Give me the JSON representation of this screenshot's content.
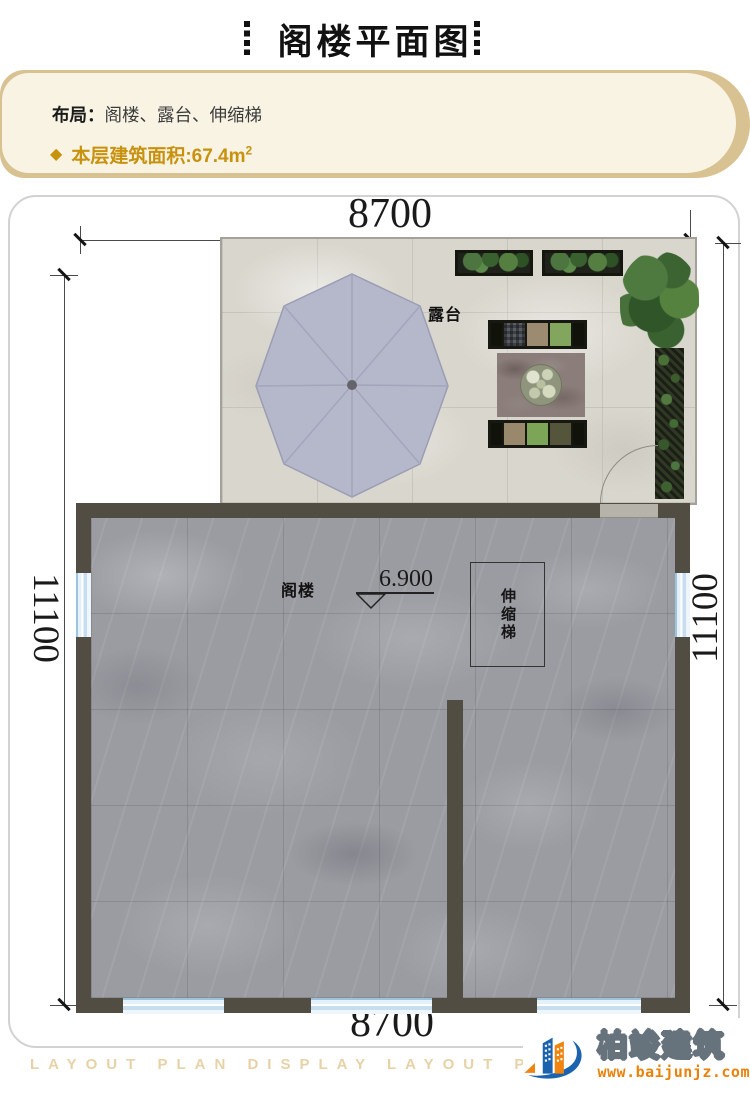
{
  "header": {
    "title": "阁楼平面图"
  },
  "info": {
    "layout_label": "布局：",
    "layout_value": "阁楼、露台、伸缩梯",
    "diamond_icon": "◆",
    "area_label": "本层建筑面积:",
    "area_value": "67.4m",
    "area_sup": "2"
  },
  "plan": {
    "dims": {
      "top": "8700",
      "bottom": "8700",
      "left": "11100",
      "right": "11100"
    },
    "terrace_label": "露台",
    "attic_label": "阁楼",
    "ladder_label": "伸缩梯",
    "elevation": "6.900"
  },
  "footer": {
    "watermark": "LAYOUT PLAN DISPLAY LAYOUT PLAN DI",
    "brand_name": "柏竣建筑",
    "website": "www.baijunjz.com"
  },
  "colors": {
    "accent_gold": "#c8920f",
    "panel_cream": "#f8f3e3",
    "panel_tan": "#d9c292",
    "wall": "#514d43",
    "marble": "#9a9ca2",
    "terrace_floor": "#d9d6cd",
    "window_blue": "#cfe6f4",
    "umbrella": "#b5b8cb",
    "brand_blue": "#1c63ad",
    "brand_orange": "#f08411"
  }
}
